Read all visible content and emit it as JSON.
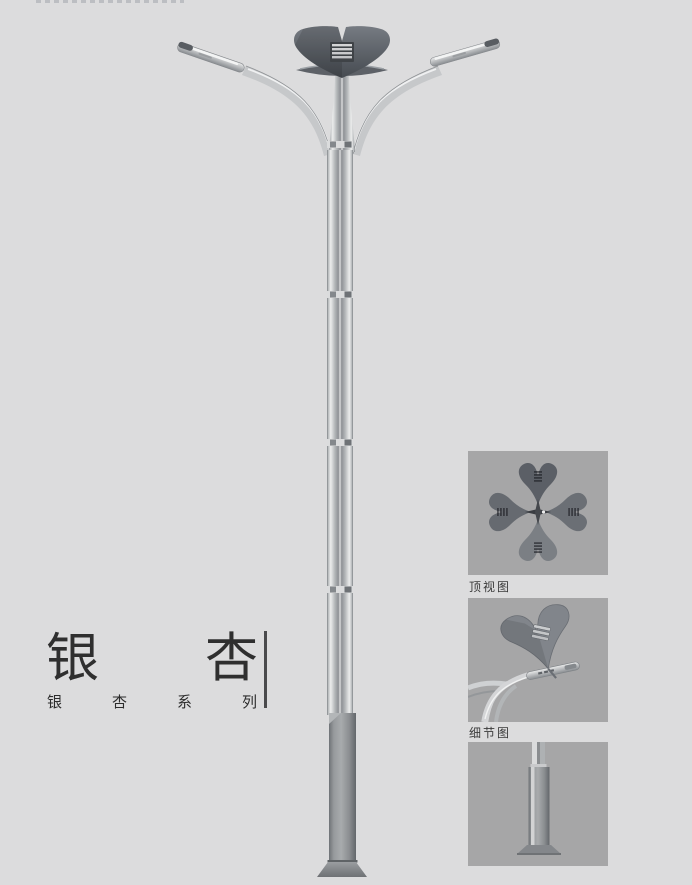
{
  "page": {
    "background": "#dcdcdd",
    "description_colors": {
      "panel_background": "#a6a6a7",
      "metal_light": "#d8d9da",
      "metal_dark": "#5a5f66",
      "text": "#2f2f2f"
    }
  },
  "title_block": {
    "main_chars": [
      "银",
      "杏"
    ],
    "series_chars": [
      "银",
      "杏",
      "系",
      "列"
    ]
  },
  "insets": {
    "top_view": {
      "label": "顶视图"
    },
    "detail": {
      "label": "细节图"
    },
    "base": {
      "label": ""
    }
  }
}
